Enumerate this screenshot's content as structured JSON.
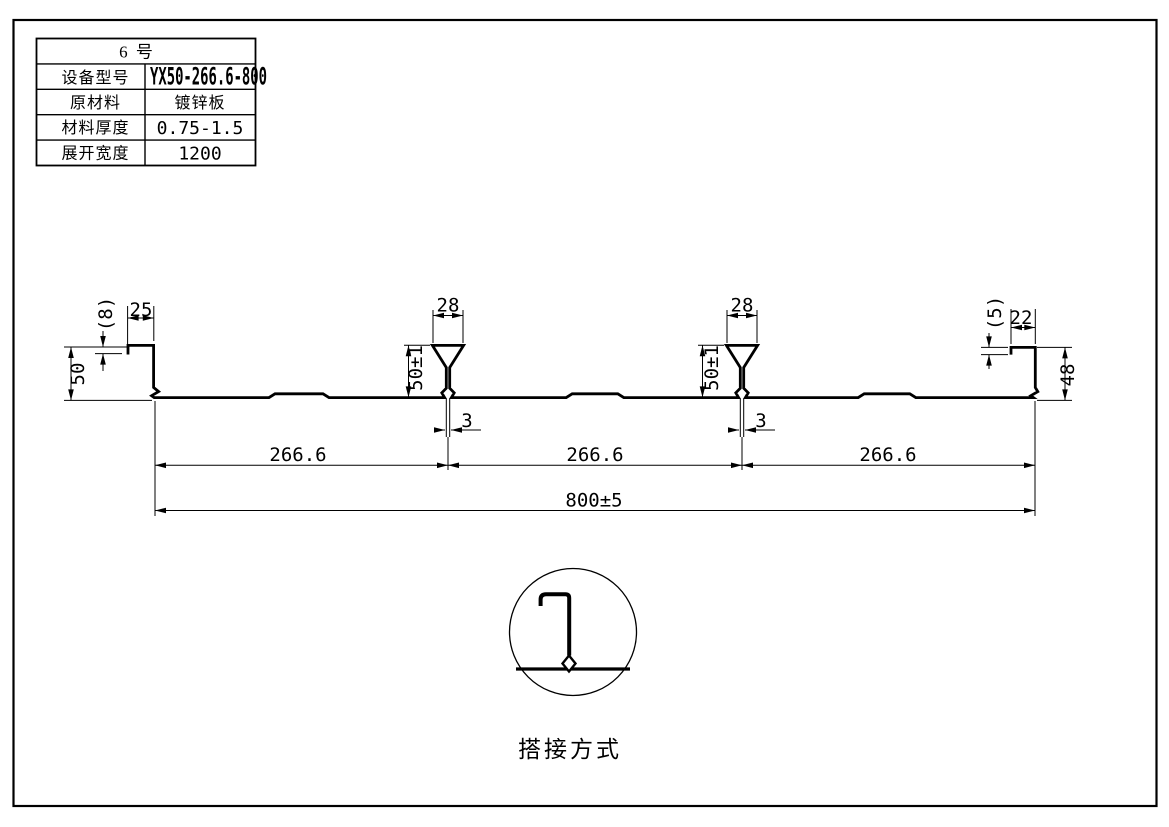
{
  "title_block": {
    "header": "6 号",
    "rows": [
      {
        "label": "设备型号",
        "value": "YX50-266.6-800"
      },
      {
        "label": "原材料",
        "value": "镀锌板"
      },
      {
        "label": "材料厚度",
        "value": "0.75-1.5"
      },
      {
        "label": "展开宽度",
        "value": "1200"
      }
    ]
  },
  "dims": {
    "left": {
      "step": "(8)",
      "lip": "25",
      "height": "50"
    },
    "rib1": {
      "top": "28",
      "height": "50±1",
      "stem": "3"
    },
    "rib2": {
      "top": "28",
      "height": "50±1",
      "stem": "3"
    },
    "right": {
      "step": "(5)",
      "lip": "22",
      "height": "48"
    },
    "pitches": [
      "266.6",
      "266.6",
      "266.6"
    ],
    "overall": "800±5"
  },
  "detail": {
    "caption": "搭接方式"
  },
  "colors": {
    "line": "#000000",
    "background": "#ffffff"
  }
}
